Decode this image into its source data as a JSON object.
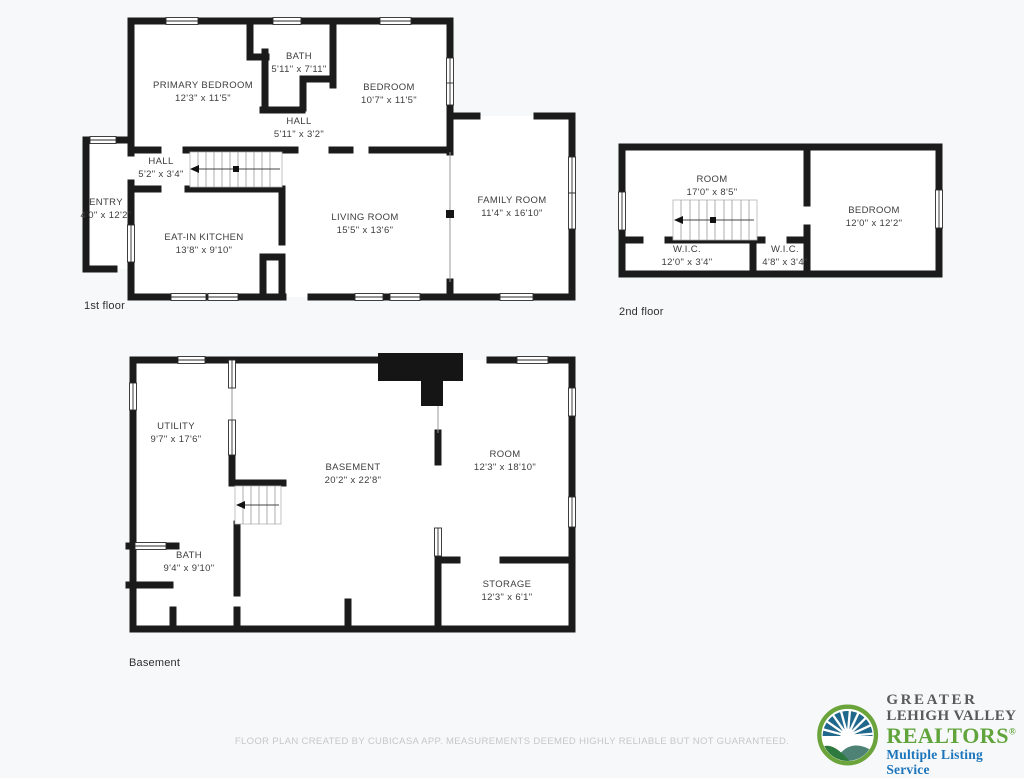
{
  "page": {
    "background": "#f7f8f9",
    "footer_disclaimer": "FLOOR PLAN CREATED BY CUBICASA APP. MEASUREMENTS DEEMED HIGHLY RELIABLE BUT NOT GUARANTEED."
  },
  "floors": [
    {
      "tag": "1st floor",
      "rooms": [
        {
          "name": "PRIMARY BEDROOM",
          "dims": "12'3\" x 11'5\""
        },
        {
          "name": "BATH",
          "dims": "5'11\" x 7'11\""
        },
        {
          "name": "BEDROOM",
          "dims": "10'7\" x 11'5\""
        },
        {
          "name": "HALL",
          "dims": "5'11\" x 3'2\""
        },
        {
          "name": "HALL",
          "dims": "5'2\" x 3'4\""
        },
        {
          "name": "ENTRY",
          "dims": "4'0\" x 12'2\""
        },
        {
          "name": "EAT-IN KITCHEN",
          "dims": "13'8\" x 9'10\""
        },
        {
          "name": "LIVING ROOM",
          "dims": "15'5\" x 13'6\""
        },
        {
          "name": "FAMILY ROOM",
          "dims": "11'4\" x 16'10\""
        }
      ]
    },
    {
      "tag": "2nd floor",
      "rooms": [
        {
          "name": "ROOM",
          "dims": "17'0\" x 8'5\""
        },
        {
          "name": "W.I.C.",
          "dims": "12'0\" x 3'4\""
        },
        {
          "name": "W.I.C.",
          "dims": "4'8\" x 3'4\""
        },
        {
          "name": "BEDROOM",
          "dims": "12'0\" x 12'2\""
        }
      ]
    },
    {
      "tag": "Basement",
      "rooms": [
        {
          "name": "UTILITY",
          "dims": "9'7\" x 17'6\""
        },
        {
          "name": "BASEMENT",
          "dims": "20'2\" x 22'8\""
        },
        {
          "name": "ROOM",
          "dims": "12'3\" x 18'10\""
        },
        {
          "name": "BATH",
          "dims": "9'4\" x 9'10\""
        },
        {
          "name": "STORAGE",
          "dims": "12'3\" x 6'1\""
        }
      ]
    }
  ],
  "logo": {
    "line1": "GREATER",
    "line2": "LEHIGH VALLEY",
    "line3": "REALTORS",
    "registered": "®",
    "tagline": "Multiple Listing Service",
    "colors": {
      "gray": "#58595b",
      "green": "#61a43c",
      "blue": "#1c75bc",
      "ring_green": "#6ba43a"
    }
  },
  "colors": {
    "wall": "#1b1b1b",
    "label_text": "#3d3d3d",
    "footer_text": "#c7c7c7"
  }
}
